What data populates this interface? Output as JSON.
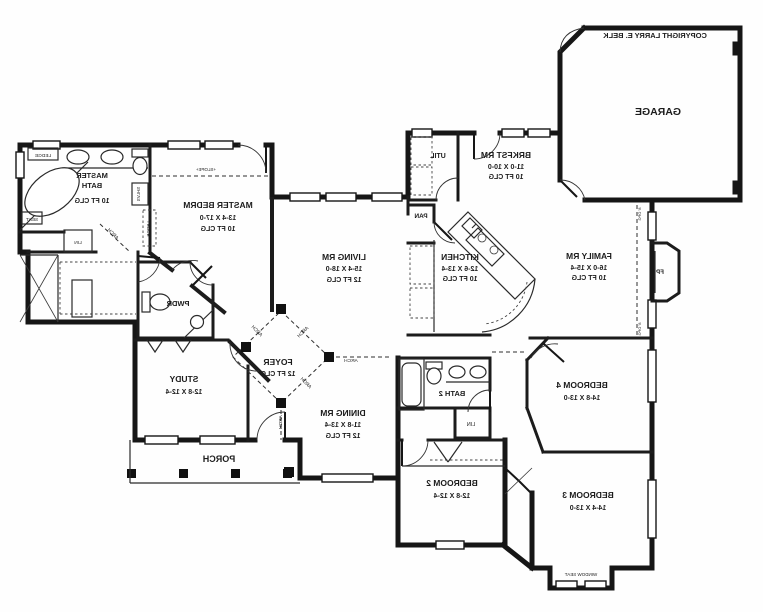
{
  "plan": {
    "copyright": "COPYRIGHT LARRY E. BELK",
    "rooms": {
      "garage": {
        "name": "GARAGE"
      },
      "brkfst": {
        "name": "BRKFST RM",
        "dim": "11-0 X 10-0",
        "clg": "10 FT CLG"
      },
      "util": {
        "name": "UTIL"
      },
      "pan": {
        "name": "PAN"
      },
      "kitchen": {
        "name": "KITCHEN",
        "dim": "12-6 X 13-4",
        "clg": "10 FT CLG"
      },
      "family": {
        "name": "FAMILY RM",
        "dim": "16-0 X 15-4",
        "clg": "10 FT CLG"
      },
      "living": {
        "name": "LIVING RM",
        "dim": "15-4 X 18-0",
        "clg": "12 FT CLG"
      },
      "master_bedrm": {
        "name": "MASTER BEDRM",
        "dim": "13-4 X 17-0",
        "clg": "10 FT CLG"
      },
      "master_bath": {
        "l1": "MASTER",
        "l2": "BATH",
        "clg": "10 FT CLG"
      },
      "pwdr": {
        "name": "PWDR"
      },
      "study": {
        "name": "STUDY",
        "dim": "12-8 X 12-4"
      },
      "foyer": {
        "name": "FOYER",
        "clg": "12 FT CLG"
      },
      "dining": {
        "name": "DINING RM",
        "dim": "11-8 X 13-4",
        "clg": "12 FT CLG"
      },
      "porch": {
        "name": "PORCH"
      },
      "bath2": {
        "name": "BATH 2"
      },
      "bed2": {
        "name": "BEDROOM 2",
        "dim": "12-8 X 12-4"
      },
      "bed3": {
        "name": "BEDROOM 3",
        "dim": "14-4 X 13-0"
      },
      "bed4": {
        "name": "BEDROOM 4",
        "dim": "14-8 X 13-0"
      }
    },
    "annotations": {
      "fp": "FP",
      "window_seat": "WINDOW SEAT",
      "ledge": "LEDGE",
      "seat": "SEAT",
      "lin": "LIN",
      "shlvs": "SHLVS",
      "arch": "ARCH",
      "slope": "+SLOPE+",
      "opg": "8' OPG"
    },
    "colors": {
      "ink": "#1c1c1c",
      "paper": "#fefefe"
    }
  }
}
